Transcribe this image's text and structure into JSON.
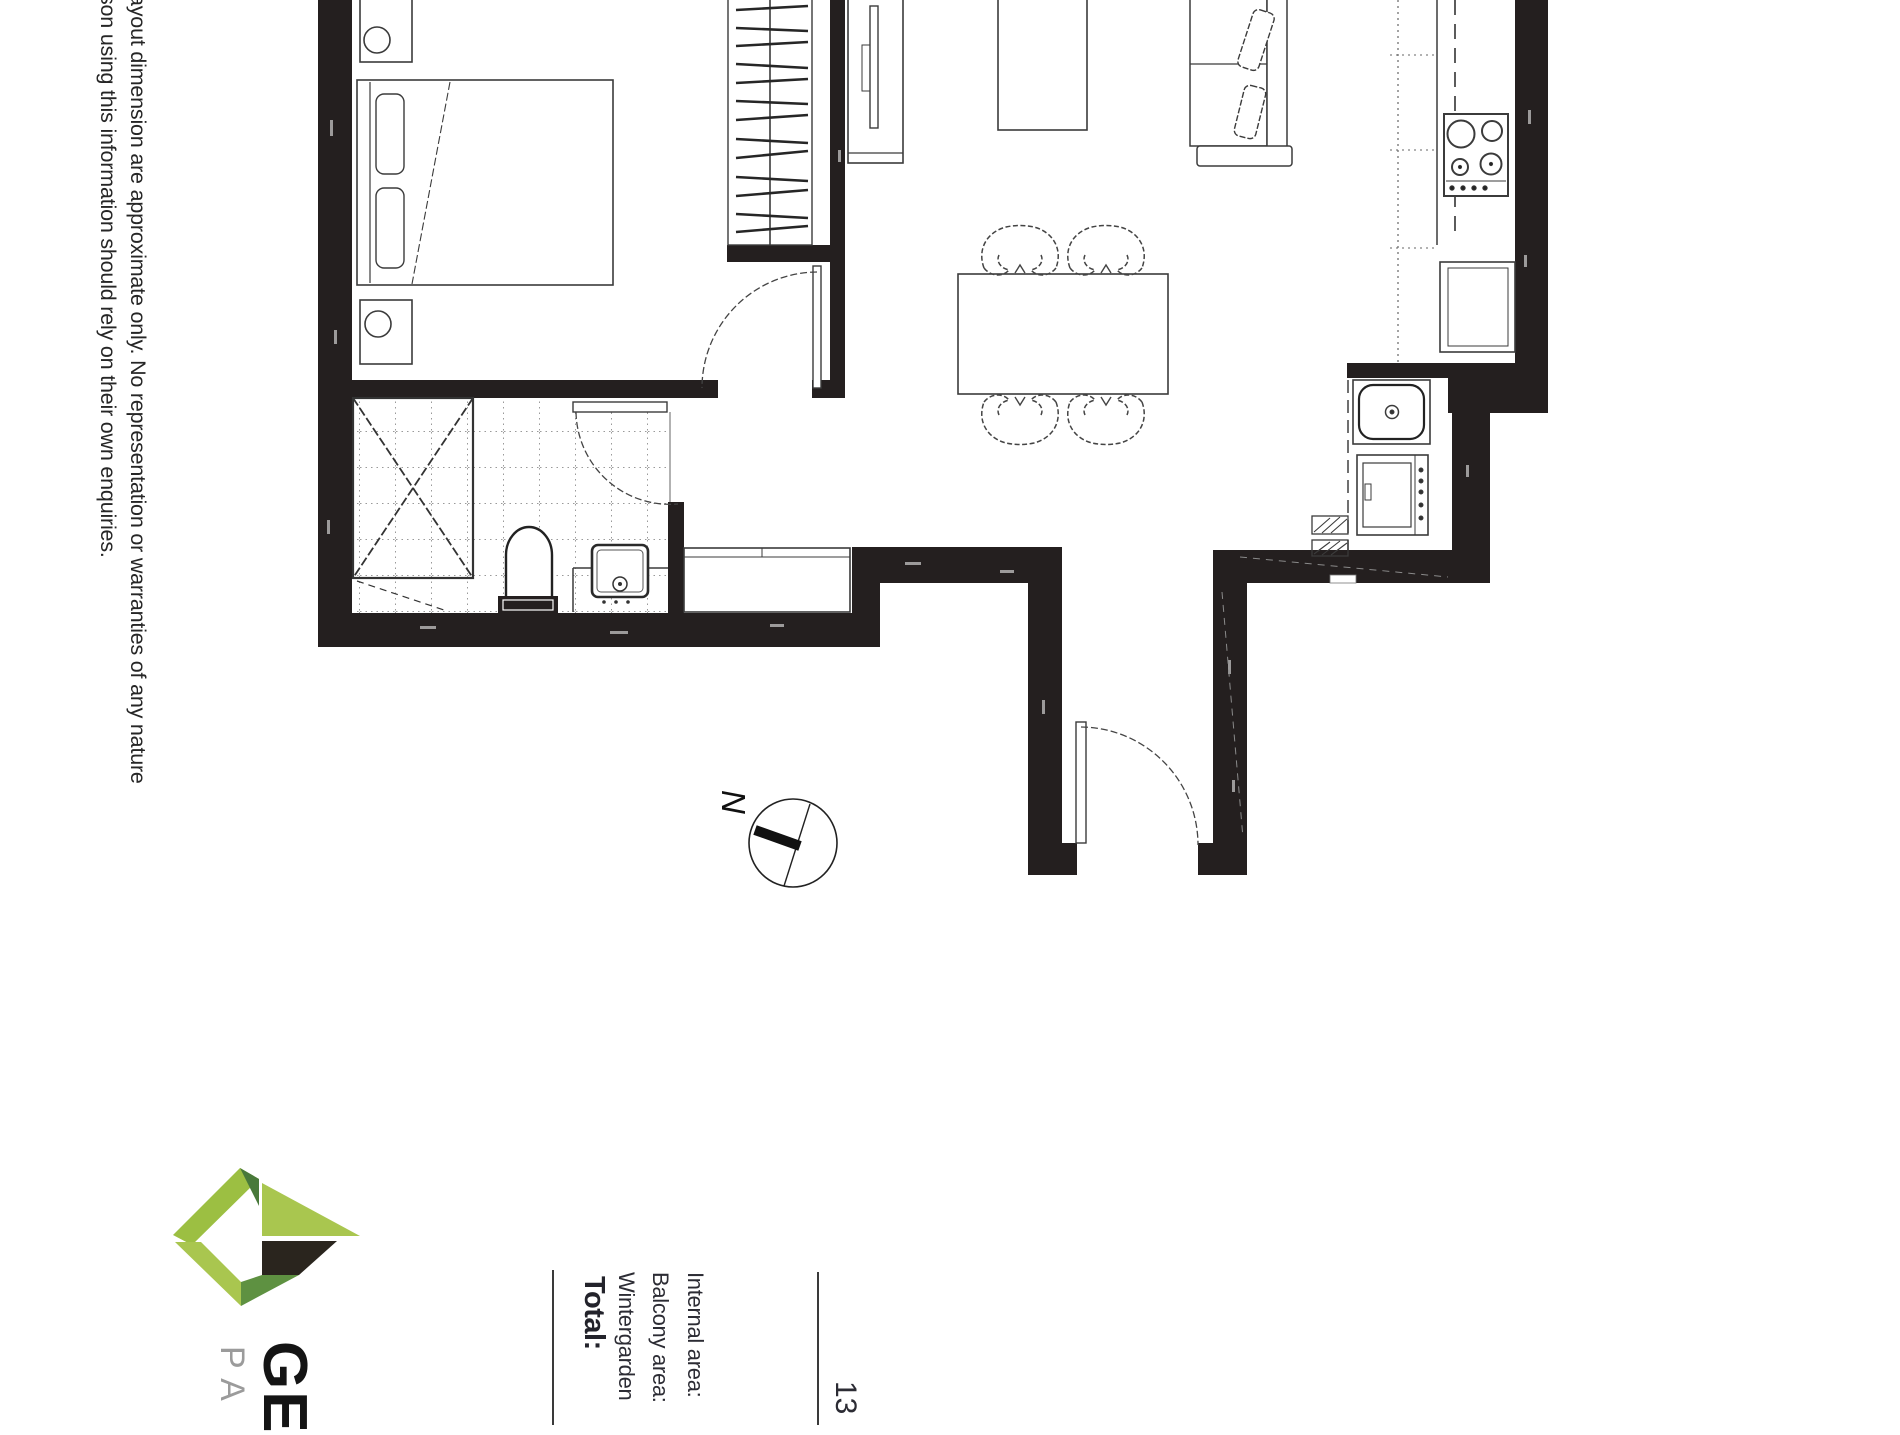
{
  "page": {
    "background": "#ffffff",
    "orientation_note": "portrait floor-plan sheet rotated 90 degrees clockwise"
  },
  "disclaimer": {
    "line1": "ayout dimension are approximate only. No representation or warranties of any nature",
    "line2": "son using this information should rely on their own enquiries."
  },
  "area_summary": {
    "internal_label": "Internal area:",
    "balcony_label": "Balcony area:",
    "wintergarden_label": "Wintergarden",
    "total_label": "Total:",
    "value_fragment": "13"
  },
  "compass": {
    "north_label": "N"
  },
  "logo": {
    "primary_text": "GE",
    "secondary_text": "PA",
    "colors": {
      "light_green": "#a9c64f",
      "mid_green": "#5e9141",
      "dark_green": "#48793a",
      "dark_block": "#2a251e"
    }
  },
  "floorplan": {
    "wall_color": "#241f1f",
    "line_color": "#3b3b3b",
    "tile_dot_color": "#9a9a9a"
  }
}
